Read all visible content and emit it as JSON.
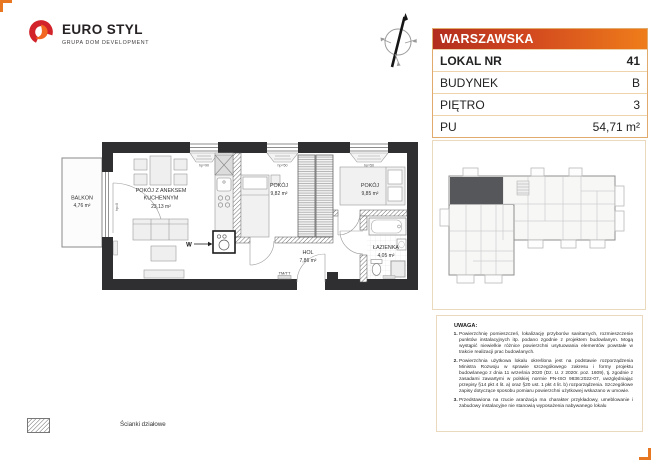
{
  "logo": {
    "name": "EURO STYL",
    "tagline": "GRUPA DOM DEVELOPMENT"
  },
  "unit_card": {
    "street": "WARSZAWSKA",
    "rows": [
      {
        "label": "LOKAL NR",
        "value": "41"
      },
      {
        "label": "BUDYNEK",
        "value": "B"
      },
      {
        "label": "PIĘTRO",
        "value": "3"
      },
      {
        "label": "PU",
        "value": "54,71 m²"
      }
    ]
  },
  "plan": {
    "rooms": [
      {
        "name": "BALKON",
        "area": "4,76 m²"
      },
      {
        "name": "POKÓJ Z ANEKSEM",
        "name2": "KUCHENNYM",
        "area": "23,13 m²"
      },
      {
        "name": "POKÓJ",
        "area": "9,82 m²"
      },
      {
        "name": "POKÓJ",
        "area": "9,85 m²"
      },
      {
        "name": "HOL",
        "area": "7,86 m²"
      },
      {
        "name": "ŁAZIENKA",
        "area": "4,05 m²"
      }
    ],
    "annotations": {
      "washer": "W",
      "meter": "TM/TT",
      "door_height": "hp=0",
      "window_height_90": "hp=90",
      "window_height_50": "hp=50"
    }
  },
  "legend": {
    "partition_walls": "Ścianki działowe"
  },
  "notes": {
    "title": "UWAGA:",
    "items": [
      "Powierzchnię pomieszczeń, lokalizację przyborów sanitarnych, rozmieszczenie punktów instalacyjnych itp. podano zgodnie z projektem budowlanym. Mogą wystąpić niewielkie różnice powierzchni usytuowania elementów powstałe w trakcie realizacji prac budowlanych.",
      "Powierzchnia użytkowa lokalu określona jest na podstawie rozporządzenia Ministra Rozwoju w sprawie szczegółowego zakresu i formy projektu budowlanego z dnia 11 września 2020 (Dz. U. z 2020r. poz. 1609), tj. zgodnie z zasadami zawartymi w polskiej normie PN-ISO 9836:2022-07, uwzględniając przepisy §14 pkt 4 lit. a) oraz §20 ust. 1 pkt 4 lit. b) rozporządzenia. Szczegółowe zapisy dotyczące sposobu pomiaru powierzchni użytkowej wskazano w umowie.",
      "Przedstawiona na rzucie aranżacja ma charakter przykładowy, umeblowanie i zabudowy instalacyjne nie stanowią wyposażenia nabywanego lokalu"
    ]
  },
  "colors": {
    "accent_red": "#b22d1e",
    "accent_orange": "#ef7d1a",
    "table_border": "#e2ab6e",
    "panel_border": "#ead9bc",
    "wall": "#2f2f31",
    "highlighted_unit": "#56575b"
  }
}
